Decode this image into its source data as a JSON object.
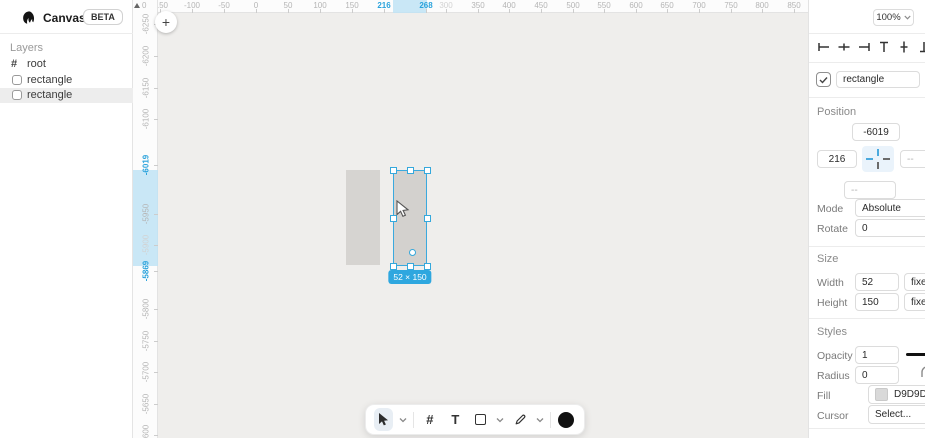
{
  "app": {
    "title": "Canvas",
    "beta_badge": "BETA"
  },
  "sidebar": {
    "layers_label": "Layers",
    "root_label": "root",
    "items": [
      {
        "label": "rectangle"
      },
      {
        "label": "rectangle"
      }
    ],
    "selected_index": 1
  },
  "canvas": {
    "corner_zero": "0",
    "plus_button": "+",
    "size_badge": "52 × 150",
    "h_ruler": {
      "ticks": [
        {
          "label": "-150",
          "x": 27
        },
        {
          "label": "-100",
          "x": 59
        },
        {
          "label": "-50",
          "x": 91
        },
        {
          "label": "0",
          "x": 123
        },
        {
          "label": "50",
          "x": 155
        },
        {
          "label": "100",
          "x": 187
        },
        {
          "label": "150",
          "x": 219
        },
        {
          "label": "216",
          "x": 251,
          "accent": true
        },
        {
          "label": "268",
          "x": 293,
          "accent": true
        },
        {
          "label": "300",
          "x": 313,
          "dim": true
        },
        {
          "label": "350",
          "x": 345
        },
        {
          "label": "400",
          "x": 376
        },
        {
          "label": "450",
          "x": 408
        },
        {
          "label": "500",
          "x": 440
        },
        {
          "label": "550",
          "x": 471
        },
        {
          "label": "600",
          "x": 503
        },
        {
          "label": "650",
          "x": 534
        },
        {
          "label": "700",
          "x": 566
        },
        {
          "label": "750",
          "x": 598
        },
        {
          "label": "800",
          "x": 629
        },
        {
          "label": "850",
          "x": 661
        }
      ],
      "highlight": {
        "x": 260,
        "w": 34
      }
    },
    "v_ruler": {
      "ticks": [
        {
          "label": "-6250",
          "y": 24
        },
        {
          "label": "-6200",
          "y": 56
        },
        {
          "label": "-6150",
          "y": 88
        },
        {
          "label": "-6100",
          "y": 119
        },
        {
          "label": "-6019",
          "y": 165,
          "accent": true
        },
        {
          "label": "-5950",
          "y": 214
        },
        {
          "label": "-5900",
          "y": 245,
          "dim": true
        },
        {
          "label": "-5869",
          "y": 271,
          "accent": true
        },
        {
          "label": "-5800",
          "y": 309
        },
        {
          "label": "-5750",
          "y": 341
        },
        {
          "label": "-5700",
          "y": 372
        },
        {
          "label": "-5650",
          "y": 404
        },
        {
          "label": "-5600",
          "y": 435
        }
      ],
      "highlight": {
        "y": 170,
        "h": 96
      }
    },
    "shapes": {
      "unselected_rect": {
        "x": 213,
        "y": 170,
        "w": 34,
        "h": 95
      },
      "selected_rect": {
        "x": 260,
        "y": 170,
        "w": 34,
        "h": 96
      }
    }
  },
  "toolbar": {
    "tools": [
      "select-tool",
      "grid-tool",
      "text-tool",
      "rectangle-tool",
      "pen-tool",
      "color-swatch"
    ],
    "text_tool_glyph": "T",
    "grid_tool_glyph": "#",
    "accent_color": "#35a8dc"
  },
  "panel": {
    "zoom_value": "100%",
    "name_field": {
      "checked": true,
      "value": "rectangle"
    },
    "position": {
      "title": "Position",
      "top": "-6019",
      "left": "216",
      "right": "--",
      "bottom": "--",
      "mode_label": "Mode",
      "mode_value": "Absolute",
      "rotate_label": "Rotate",
      "rotate_value": "0"
    },
    "size": {
      "title": "Size",
      "width_label": "Width",
      "width_value": "52",
      "width_unit": "fixed",
      "height_label": "Height",
      "height_value": "150",
      "height_unit": "fixed"
    },
    "styles": {
      "title": "Styles",
      "opacity_label": "Opacity",
      "opacity_value": "1",
      "radius_label": "Radius",
      "radius_value": "0",
      "fill_label": "Fill",
      "fill_value": "D9D9D9",
      "fill_color": "#D9D9D9",
      "cursor_label": "Cursor",
      "cursor_value": "Select..."
    }
  },
  "colors": {
    "accent_blue": "#2ba3dc",
    "ruler_highlight": "#bfe3f5",
    "shape_fill": "#D9D9D9",
    "canvas_bg": "#efeeec"
  }
}
